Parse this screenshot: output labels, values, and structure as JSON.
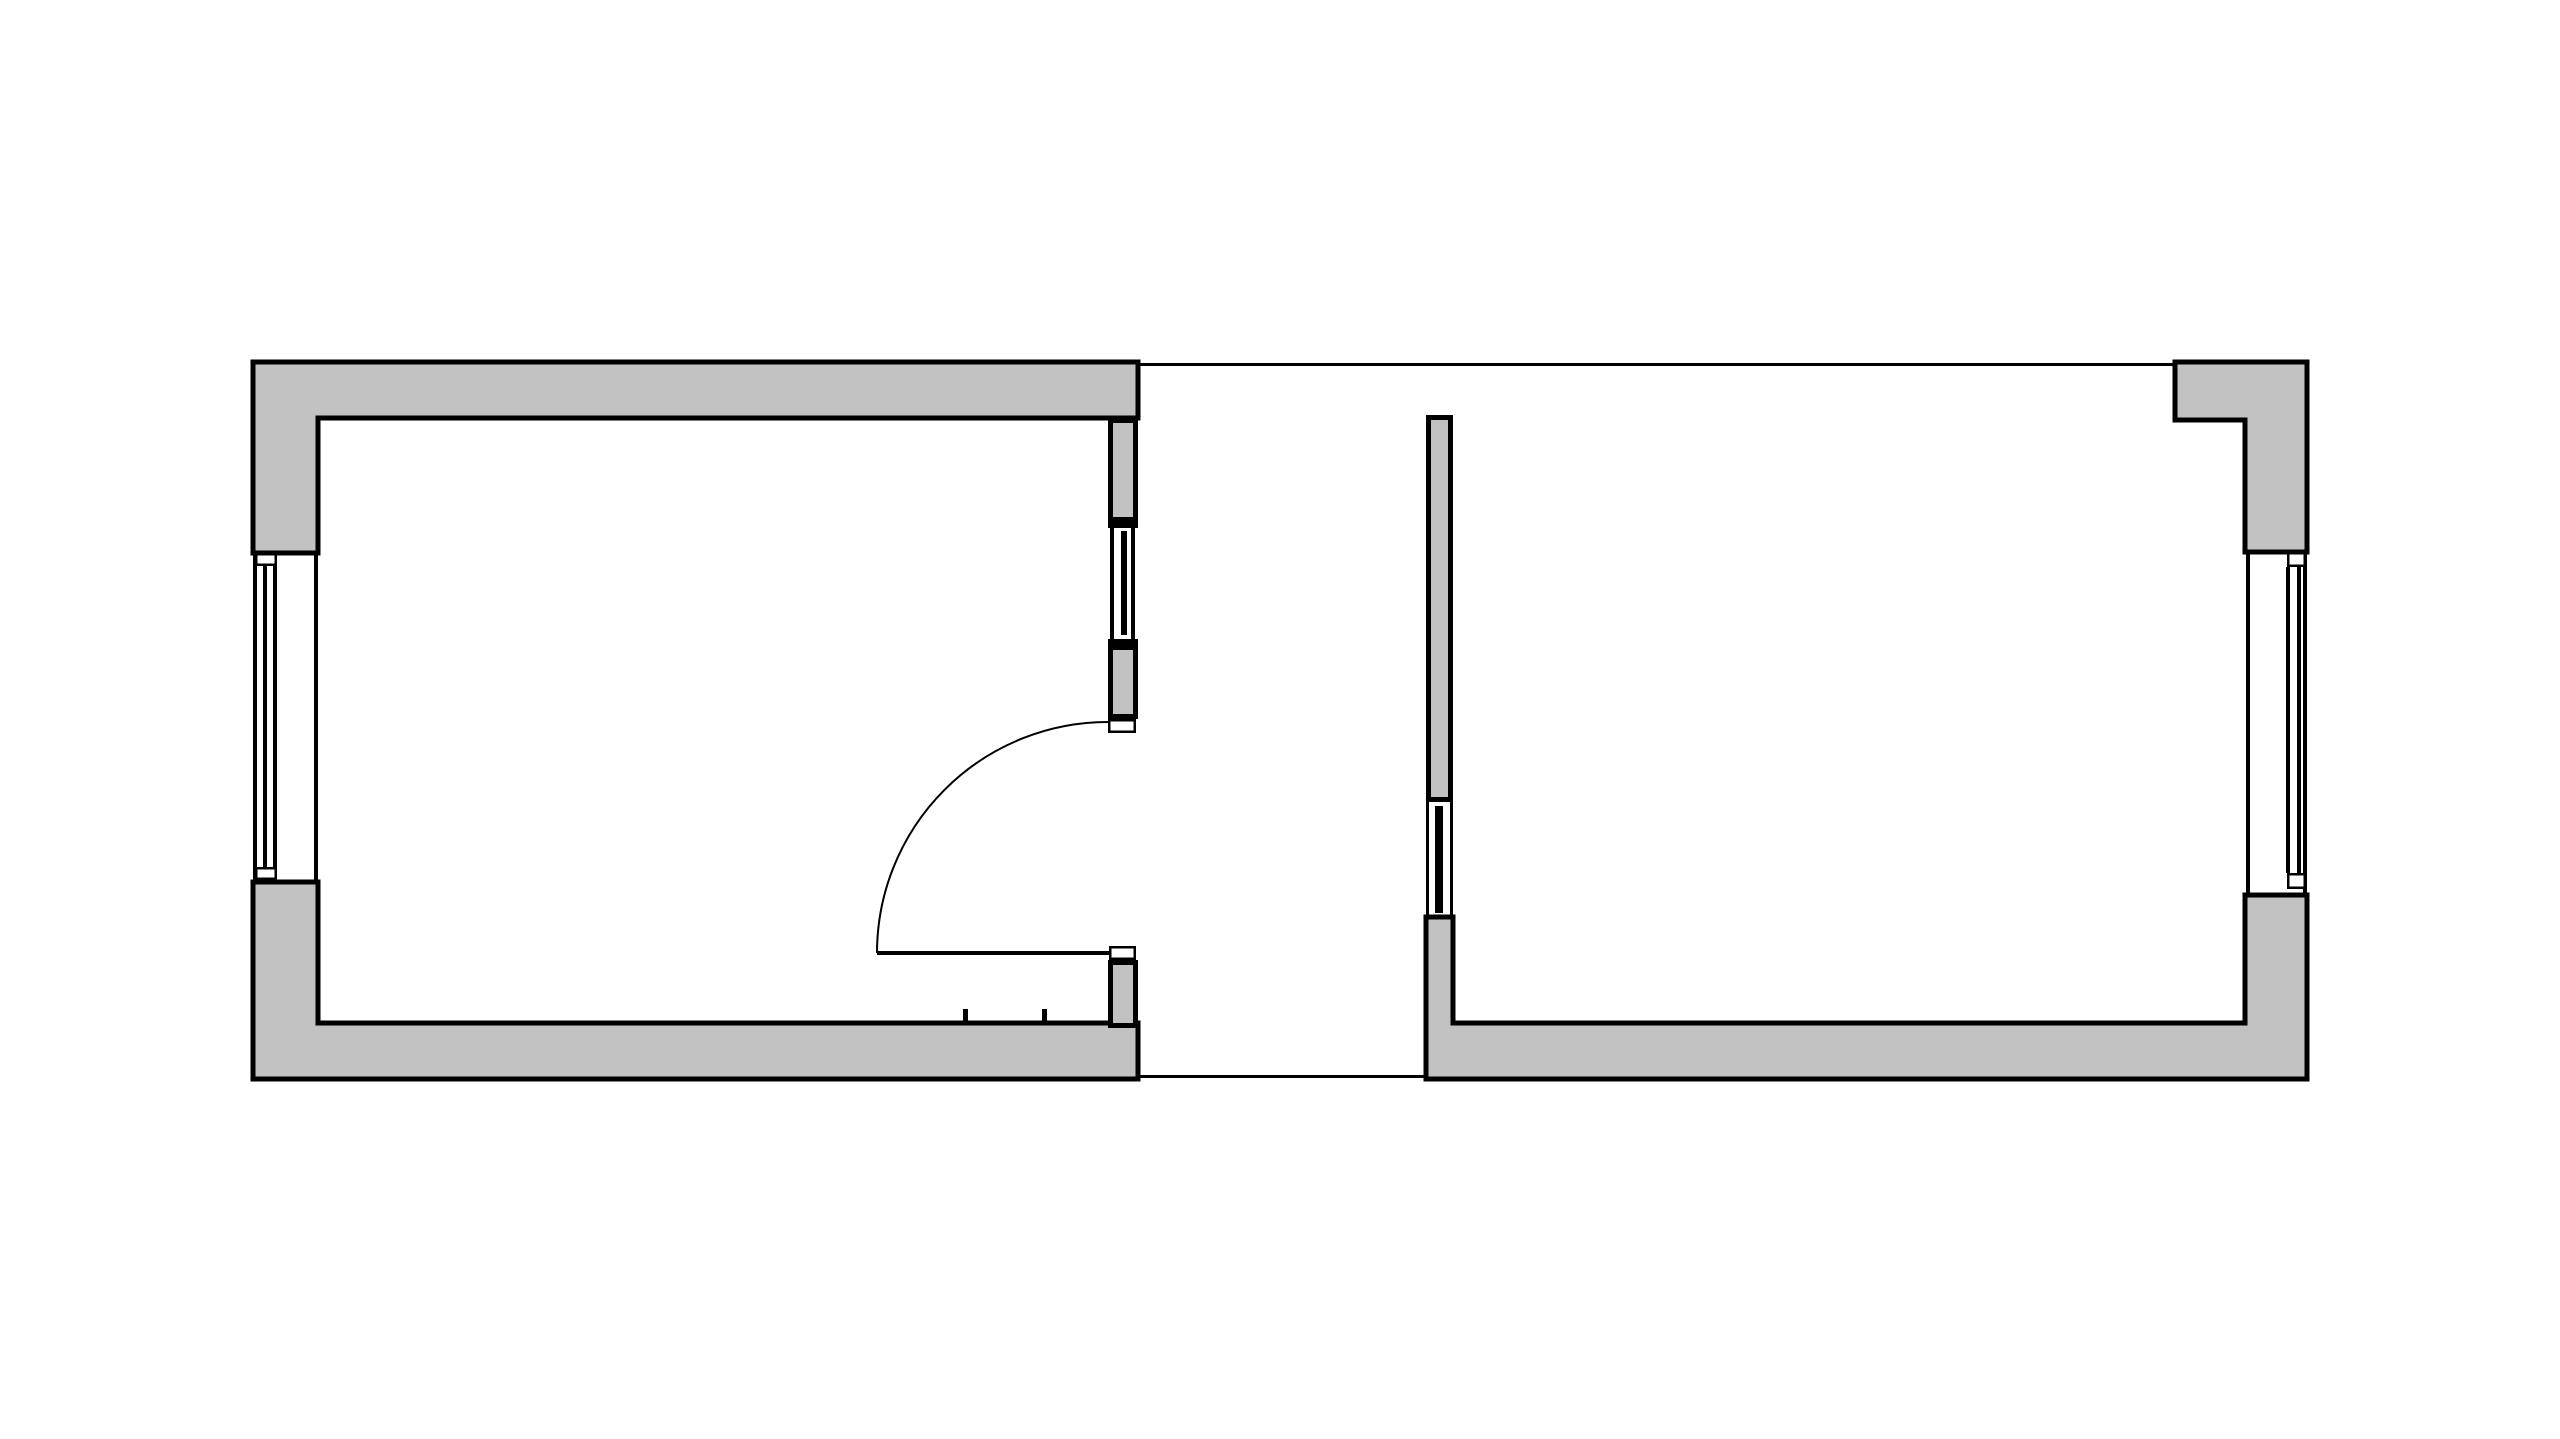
{
  "meta": {
    "description": "Architectural floor plan drawing: two rectangular rooms separated by an open gap, left room with entry door and three windows, right room with partition wall panel and one exterior window",
    "canvas_width": 2560,
    "canvas_height": 1439,
    "background": "#ffffff"
  },
  "colors": {
    "wall": "#c2c2c2",
    "black": "#000000",
    "white": "#ffffff"
  },
  "rooms": [
    {
      "id": "left-room",
      "outer": [
        253,
        362,
        1138,
        1079
      ]
    },
    {
      "id": "right-room",
      "outer": [
        1426,
        362,
        2307,
        1079
      ]
    }
  ],
  "elements": [
    {
      "name": "left-room-top-and-left-wall",
      "kind": "wall",
      "shape": "path",
      "d": "M253,362 L1138,362 L1138,418 L318,418 L318,553 L253,553 Z",
      "fill": "wall",
      "stroke": "black",
      "sw": 5
    },
    {
      "name": "left-room-bottom-and-left-wall",
      "kind": "wall",
      "shape": "path",
      "d": "M253,882 L318,882 L318,1023 L1138,1023 L1138,1079 L253,1079 Z",
      "fill": "wall",
      "stroke": "black",
      "sw": 5
    },
    {
      "name": "left-room-right-wall-upper",
      "kind": "wall",
      "shape": "rect",
      "x": 1108,
      "y": 418,
      "w": 30,
      "h": 104,
      "fill": "wall",
      "stroke": "black",
      "sw": 5
    },
    {
      "name": "left-room-right-wall-mid",
      "kind": "wall",
      "shape": "rect",
      "x": 1108,
      "y": 645,
      "w": 30,
      "h": 74,
      "fill": "wall",
      "stroke": "black",
      "sw": 5
    },
    {
      "name": "left-room-right-wall-lower",
      "kind": "wall",
      "shape": "rect",
      "x": 1108,
      "y": 960,
      "w": 30,
      "h": 68,
      "fill": "wall",
      "stroke": "black",
      "sw": 5
    },
    {
      "name": "right-wall-window-cap-top",
      "kind": "window",
      "shape": "rect",
      "x": 1108,
      "y": 522,
      "w": 30,
      "h": 6,
      "fill": "black",
      "sw": 0
    },
    {
      "name": "right-wall-window-cap-bottom",
      "kind": "window",
      "shape": "rect",
      "x": 1108,
      "y": 639,
      "w": 30,
      "h": 6,
      "fill": "black",
      "sw": 0
    },
    {
      "name": "right-wall-window-frame-inner",
      "kind": "window",
      "shape": "rect",
      "x": 1110,
      "y": 527,
      "w": 4,
      "h": 112,
      "fill": "black",
      "sw": 0
    },
    {
      "name": "right-wall-window-frame-outer",
      "kind": "window",
      "shape": "rect",
      "x": 1131,
      "y": 527,
      "w": 4,
      "h": 112,
      "fill": "black",
      "sw": 0
    },
    {
      "name": "right-wall-window-glazing",
      "kind": "window",
      "shape": "rect",
      "x": 1121,
      "y": 531,
      "w": 6,
      "h": 104,
      "fill": "black",
      "sw": 0
    },
    {
      "name": "door-jamb-upper",
      "kind": "door",
      "shape": "rect",
      "x": 1108,
      "y": 719,
      "w": 28,
      "h": 14,
      "fill": "white",
      "stroke": "black",
      "sw": 2.5
    },
    {
      "name": "door-jamb-lower",
      "kind": "door",
      "shape": "rect",
      "x": 1109,
      "y": 946,
      "w": 27,
      "h": 14,
      "fill": "white",
      "stroke": "black",
      "sw": 2.5
    },
    {
      "name": "door-leaf",
      "kind": "door",
      "shape": "rect",
      "x": 877,
      "y": 951,
      "w": 233,
      "h": 4,
      "fill": "black",
      "sw": 0
    },
    {
      "name": "door-swing-arc",
      "kind": "door",
      "shape": "path",
      "d": "M877,953 A231,231 0 0 1 1108,722",
      "fill": "none",
      "stroke": "black",
      "sw": 2
    },
    {
      "name": "threshold-tick-left",
      "kind": "mark",
      "shape": "rect",
      "x": 963,
      "y": 1009,
      "w": 5,
      "h": 16,
      "fill": "black",
      "sw": 0
    },
    {
      "name": "threshold-tick-right",
      "kind": "mark",
      "shape": "rect",
      "x": 1042,
      "y": 1009,
      "w": 5,
      "h": 16,
      "fill": "black",
      "sw": 0
    },
    {
      "name": "left-wall-window-outer-line",
      "kind": "window",
      "shape": "rect",
      "x": 253,
      "y": 553,
      "w": 4,
      "h": 327,
      "fill": "black",
      "sw": 0
    },
    {
      "name": "left-wall-window-inner-line",
      "kind": "window",
      "shape": "rect",
      "x": 314,
      "y": 553,
      "w": 4,
      "h": 327,
      "fill": "black",
      "sw": 0
    },
    {
      "name": "left-wall-window-glazing-1",
      "kind": "window",
      "shape": "rect",
      "x": 263,
      "y": 566,
      "w": 4,
      "h": 301,
      "fill": "black",
      "sw": 0
    },
    {
      "name": "left-wall-window-glazing-2",
      "kind": "window",
      "shape": "rect",
      "x": 273,
      "y": 566,
      "w": 4,
      "h": 301,
      "fill": "black",
      "sw": 0
    },
    {
      "name": "left-wall-window-frame-box-top",
      "kind": "window",
      "shape": "rect",
      "x": 255,
      "y": 553,
      "w": 22,
      "h": 13,
      "fill": "white",
      "stroke": "black",
      "sw": 2.5
    },
    {
      "name": "left-wall-window-frame-box-bottom",
      "kind": "window",
      "shape": "rect",
      "x": 255,
      "y": 867,
      "w": 22,
      "h": 13,
      "fill": "white",
      "stroke": "black",
      "sw": 2.5
    },
    {
      "name": "right-room-partition-wall-upper",
      "kind": "wall",
      "shape": "rect",
      "x": 1426,
      "y": 415,
      "w": 27,
      "h": 387,
      "fill": "wall",
      "stroke": "black",
      "sw": 5
    },
    {
      "name": "right-room-bottom-and-side-walls",
      "kind": "wall",
      "shape": "path",
      "d": "M1426,917 L1453,917 L1453,1023 L2245,1023 L2245,895 L2307,895 L2307,1079 L1426,1079 Z",
      "fill": "wall",
      "stroke": "black",
      "sw": 5
    },
    {
      "name": "right-room-top-right-corner-wall",
      "kind": "wall",
      "shape": "path",
      "d": "M2175,362 L2307,362 L2307,552 L2245,552 L2245,420 L2175,420 Z",
      "fill": "wall",
      "stroke": "black",
      "sw": 5
    },
    {
      "name": "partition-panel-frame-left",
      "kind": "window",
      "shape": "rect",
      "x": 1426,
      "y": 802,
      "w": 3,
      "h": 115,
      "fill": "black",
      "sw": 0
    },
    {
      "name": "partition-panel-frame-right",
      "kind": "window",
      "shape": "rect",
      "x": 1450,
      "y": 802,
      "w": 3,
      "h": 115,
      "fill": "black",
      "sw": 0
    },
    {
      "name": "partition-panel-glazing",
      "kind": "window",
      "shape": "rect",
      "x": 1435,
      "y": 806,
      "w": 8,
      "h": 107,
      "fill": "black",
      "sw": 0
    },
    {
      "name": "right-wall-exterior-window-inner-line",
      "kind": "window",
      "shape": "rect",
      "x": 2246,
      "y": 552,
      "w": 4,
      "h": 343,
      "fill": "black",
      "sw": 0
    },
    {
      "name": "right-wall-exterior-window-outer-line",
      "kind": "window",
      "shape": "rect",
      "x": 2303,
      "y": 552,
      "w": 4,
      "h": 343,
      "fill": "black",
      "sw": 0
    },
    {
      "name": "right-wall-exterior-window-glazing-1",
      "kind": "window",
      "shape": "rect",
      "x": 2286,
      "y": 567,
      "w": 4,
      "h": 306,
      "fill": "black",
      "sw": 0
    },
    {
      "name": "right-wall-exterior-window-glazing-2",
      "kind": "window",
      "shape": "rect",
      "x": 2297,
      "y": 567,
      "w": 4,
      "h": 306,
      "fill": "black",
      "sw": 0
    },
    {
      "name": "right-wall-exterior-window-frame-box-top",
      "kind": "window",
      "shape": "rect",
      "x": 2287,
      "y": 552,
      "w": 19,
      "h": 15,
      "fill": "white",
      "stroke": "black",
      "sw": 2.5
    },
    {
      "name": "right-wall-exterior-window-frame-box-bottom",
      "kind": "window",
      "shape": "rect",
      "x": 2287,
      "y": 873,
      "w": 19,
      "h": 16,
      "fill": "white",
      "stroke": "black",
      "sw": 2.5
    },
    {
      "name": "reference-line-top",
      "kind": "line",
      "shape": "rect",
      "x": 1138,
      "y": 363,
      "w": 1037,
      "h": 3,
      "fill": "black",
      "sw": 0
    },
    {
      "name": "reference-line-bottom",
      "kind": "line",
      "shape": "rect",
      "x": 1138,
      "y": 1075,
      "w": 288,
      "h": 3,
      "fill": "black",
      "sw": 0
    }
  ]
}
